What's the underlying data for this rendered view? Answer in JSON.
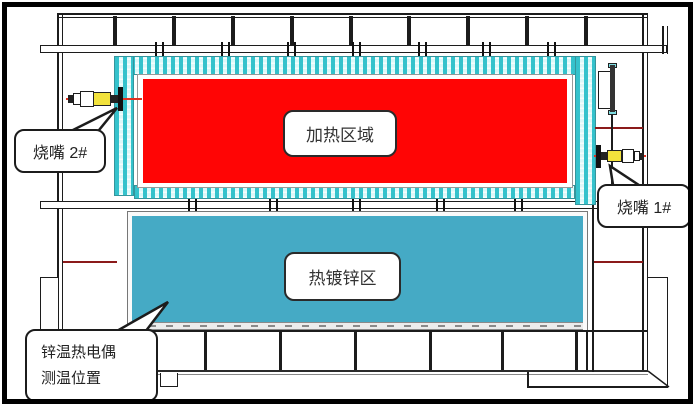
{
  "diagram": {
    "type": "furnace-galvanizing-line-schematic",
    "zones": {
      "heating": {
        "label": "加热区域",
        "fill_color": "#FF0505"
      },
      "galvanizing": {
        "label": "热镀锌区",
        "fill_color": "#45AAC5"
      }
    },
    "callouts": {
      "burner2": {
        "label": "烧嘴 2#"
      },
      "burner1": {
        "label": "烧嘴 1#"
      },
      "zinc_thermocouple": {
        "line1": "锌温热电偶",
        "line2": "测温位置"
      }
    },
    "colors": {
      "insulation_hatch": "#2BBFC9",
      "insulation_bg": "#DCF8F9",
      "structure_line": "#1C1C1C",
      "centerline_dark_red": "#8B1A1A",
      "burner_yellow": "#F2E23C",
      "border_black": "#000000"
    }
  }
}
